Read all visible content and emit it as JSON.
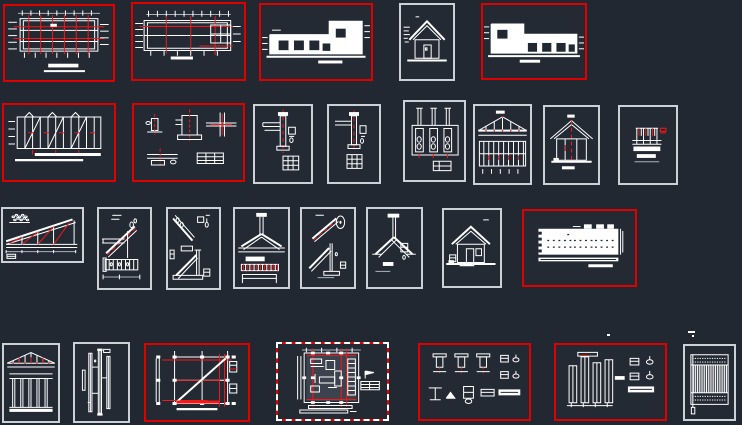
{
  "app": {
    "type": "cad-model-space-overview",
    "description": "Dark CAD canvas containing architectural drawing sheets arranged in four rows"
  },
  "canvas": {
    "width": 742,
    "height": 425,
    "background": "#212832"
  },
  "colors": {
    "background": "#212832",
    "red_border": "#df0000",
    "red_line": "#f51818",
    "gray_border": "#ccd1d7",
    "white_line": "#ffffff",
    "gray_line": "#aab2bc",
    "selected_fill": "#3c434e"
  },
  "frames": [
    {
      "id": "f01",
      "name": "frame-floor-plan-1",
      "border": "red",
      "x": 3,
      "y": 4,
      "w": 112,
      "h": 78,
      "sketch": "planA"
    },
    {
      "id": "f02",
      "name": "frame-floor-plan-2",
      "border": "red",
      "x": 131,
      "y": 2,
      "w": 115,
      "h": 79,
      "sketch": "planB"
    },
    {
      "id": "f03",
      "name": "frame-elevation-front",
      "border": "red",
      "x": 259,
      "y": 3,
      "w": 114,
      "h": 78,
      "sketch": "elevR"
    },
    {
      "id": "f04",
      "name": "frame-house-elevation-small",
      "border": "gray",
      "x": 399,
      "y": 3,
      "w": 56,
      "h": 78,
      "sketch": "houseIcon"
    },
    {
      "id": "f05",
      "name": "frame-elevation-rear",
      "border": "red",
      "x": 481,
      "y": 3,
      "w": 106,
      "h": 77,
      "sketch": "elevL"
    },
    {
      "id": "f06",
      "name": "frame-roof-framing-plan",
      "border": "red",
      "x": 2,
      "y": 103,
      "w": 114,
      "h": 79,
      "sketch": "framingPlan"
    },
    {
      "id": "f07",
      "name": "frame-connection-details",
      "border": "red",
      "x": 132,
      "y": 103,
      "w": 113,
      "h": 79,
      "sketch": "detailCluster"
    },
    {
      "id": "f08",
      "name": "frame-column-detail-1",
      "border": "gray",
      "x": 253,
      "y": 104,
      "w": 60,
      "h": 80,
      "sketch": "columnDetail"
    },
    {
      "id": "f09",
      "name": "frame-column-detail-2",
      "border": "gray",
      "x": 327,
      "y": 104,
      "w": 54,
      "h": 80,
      "sketch": "columnDetail2"
    },
    {
      "id": "f10",
      "name": "frame-column-reinforcement",
      "border": "gray",
      "x": 403,
      "y": 100,
      "w": 63,
      "h": 82,
      "sketch": "threeColumns"
    },
    {
      "id": "f11",
      "name": "frame-truss-and-bracing",
      "border": "gray",
      "x": 473,
      "y": 104,
      "w": 59,
      "h": 81,
      "sketch": "trussWall"
    },
    {
      "id": "f12",
      "name": "frame-building-cross-section",
      "border": "gray",
      "x": 543,
      "y": 105,
      "w": 57,
      "h": 80,
      "sketch": "houseSection"
    },
    {
      "id": "f13",
      "name": "frame-section-detail",
      "border": "gray",
      "x": 618,
      "y": 105,
      "w": 60,
      "h": 80,
      "sketch": "sectionDetail"
    },
    {
      "id": "f14",
      "name": "frame-half-truss-detail",
      "border": "gray",
      "x": 1,
      "y": 207,
      "w": 83,
      "h": 56,
      "sketch": "halfTruss"
    },
    {
      "id": "f15",
      "name": "frame-truss-heel-detail",
      "border": "gray",
      "x": 97,
      "y": 207,
      "w": 55,
      "h": 83,
      "sketch": "diagA"
    },
    {
      "id": "f16",
      "name": "frame-brace-detail-1",
      "border": "gray",
      "x": 166,
      "y": 207,
      "w": 55,
      "h": 83,
      "sketch": "diagB"
    },
    {
      "id": "f17",
      "name": "frame-apex-joint-detail",
      "border": "gray",
      "x": 233,
      "y": 207,
      "w": 57,
      "h": 82,
      "sketch": "apexDetail"
    },
    {
      "id": "f18",
      "name": "frame-brace-detail-2",
      "border": "gray",
      "x": 300,
      "y": 207,
      "w": 56,
      "h": 82,
      "sketch": "diagCircle"
    },
    {
      "id": "f19",
      "name": "frame-strut-joint-detail",
      "border": "gray",
      "x": 366,
      "y": 207,
      "w": 57,
      "h": 82,
      "sketch": "veeDetail"
    },
    {
      "id": "f20",
      "name": "frame-house-section-small",
      "border": "gray",
      "x": 442,
      "y": 208,
      "w": 60,
      "h": 80,
      "sketch": "houseIcon2"
    },
    {
      "id": "f21",
      "name": "frame-panel-plan",
      "border": "red",
      "x": 522,
      "y": 209,
      "w": 115,
      "h": 78,
      "sketch": "panelDots"
    },
    {
      "id": "f22",
      "name": "frame-truss-frame-elevation",
      "border": "gray",
      "x": 2,
      "y": 343,
      "w": 58,
      "h": 80,
      "sketch": "trussFrame"
    },
    {
      "id": "f23",
      "name": "frame-stud-details",
      "border": "gray",
      "x": 73,
      "y": 342,
      "w": 57,
      "h": 81,
      "sketch": "verticalMembers"
    },
    {
      "id": "f24",
      "name": "frame-foundation-plan",
      "border": "red",
      "x": 144,
      "y": 343,
      "w": 106,
      "h": 79,
      "sketch": "planDiagonal"
    },
    {
      "id": "f25",
      "name": "frame-selected-plan",
      "border": "red-dashed",
      "x": 276,
      "y": 342,
      "w": 113,
      "h": 79,
      "sketch": "planSelected"
    },
    {
      "id": "f26",
      "name": "frame-base-details-grid",
      "border": "red",
      "x": 418,
      "y": 343,
      "w": 113,
      "h": 78,
      "sketch": "detailGrid"
    },
    {
      "id": "f27",
      "name": "frame-wall-section-details",
      "border": "red",
      "x": 554,
      "y": 343,
      "w": 113,
      "h": 78,
      "sketch": "wallSections"
    },
    {
      "id": "f28",
      "name": "frame-hatched-grid-panel",
      "border": "gray",
      "x": 683,
      "y": 344,
      "w": 53,
      "h": 77,
      "sketch": "gridHatch"
    }
  ],
  "specks": [
    {
      "x": 607,
      "y": 334,
      "w": 3,
      "h": 2
    },
    {
      "x": 688,
      "y": 331,
      "w": 7,
      "h": 2
    },
    {
      "x": 692,
      "y": 335,
      "w": 2,
      "h": 2
    }
  ]
}
